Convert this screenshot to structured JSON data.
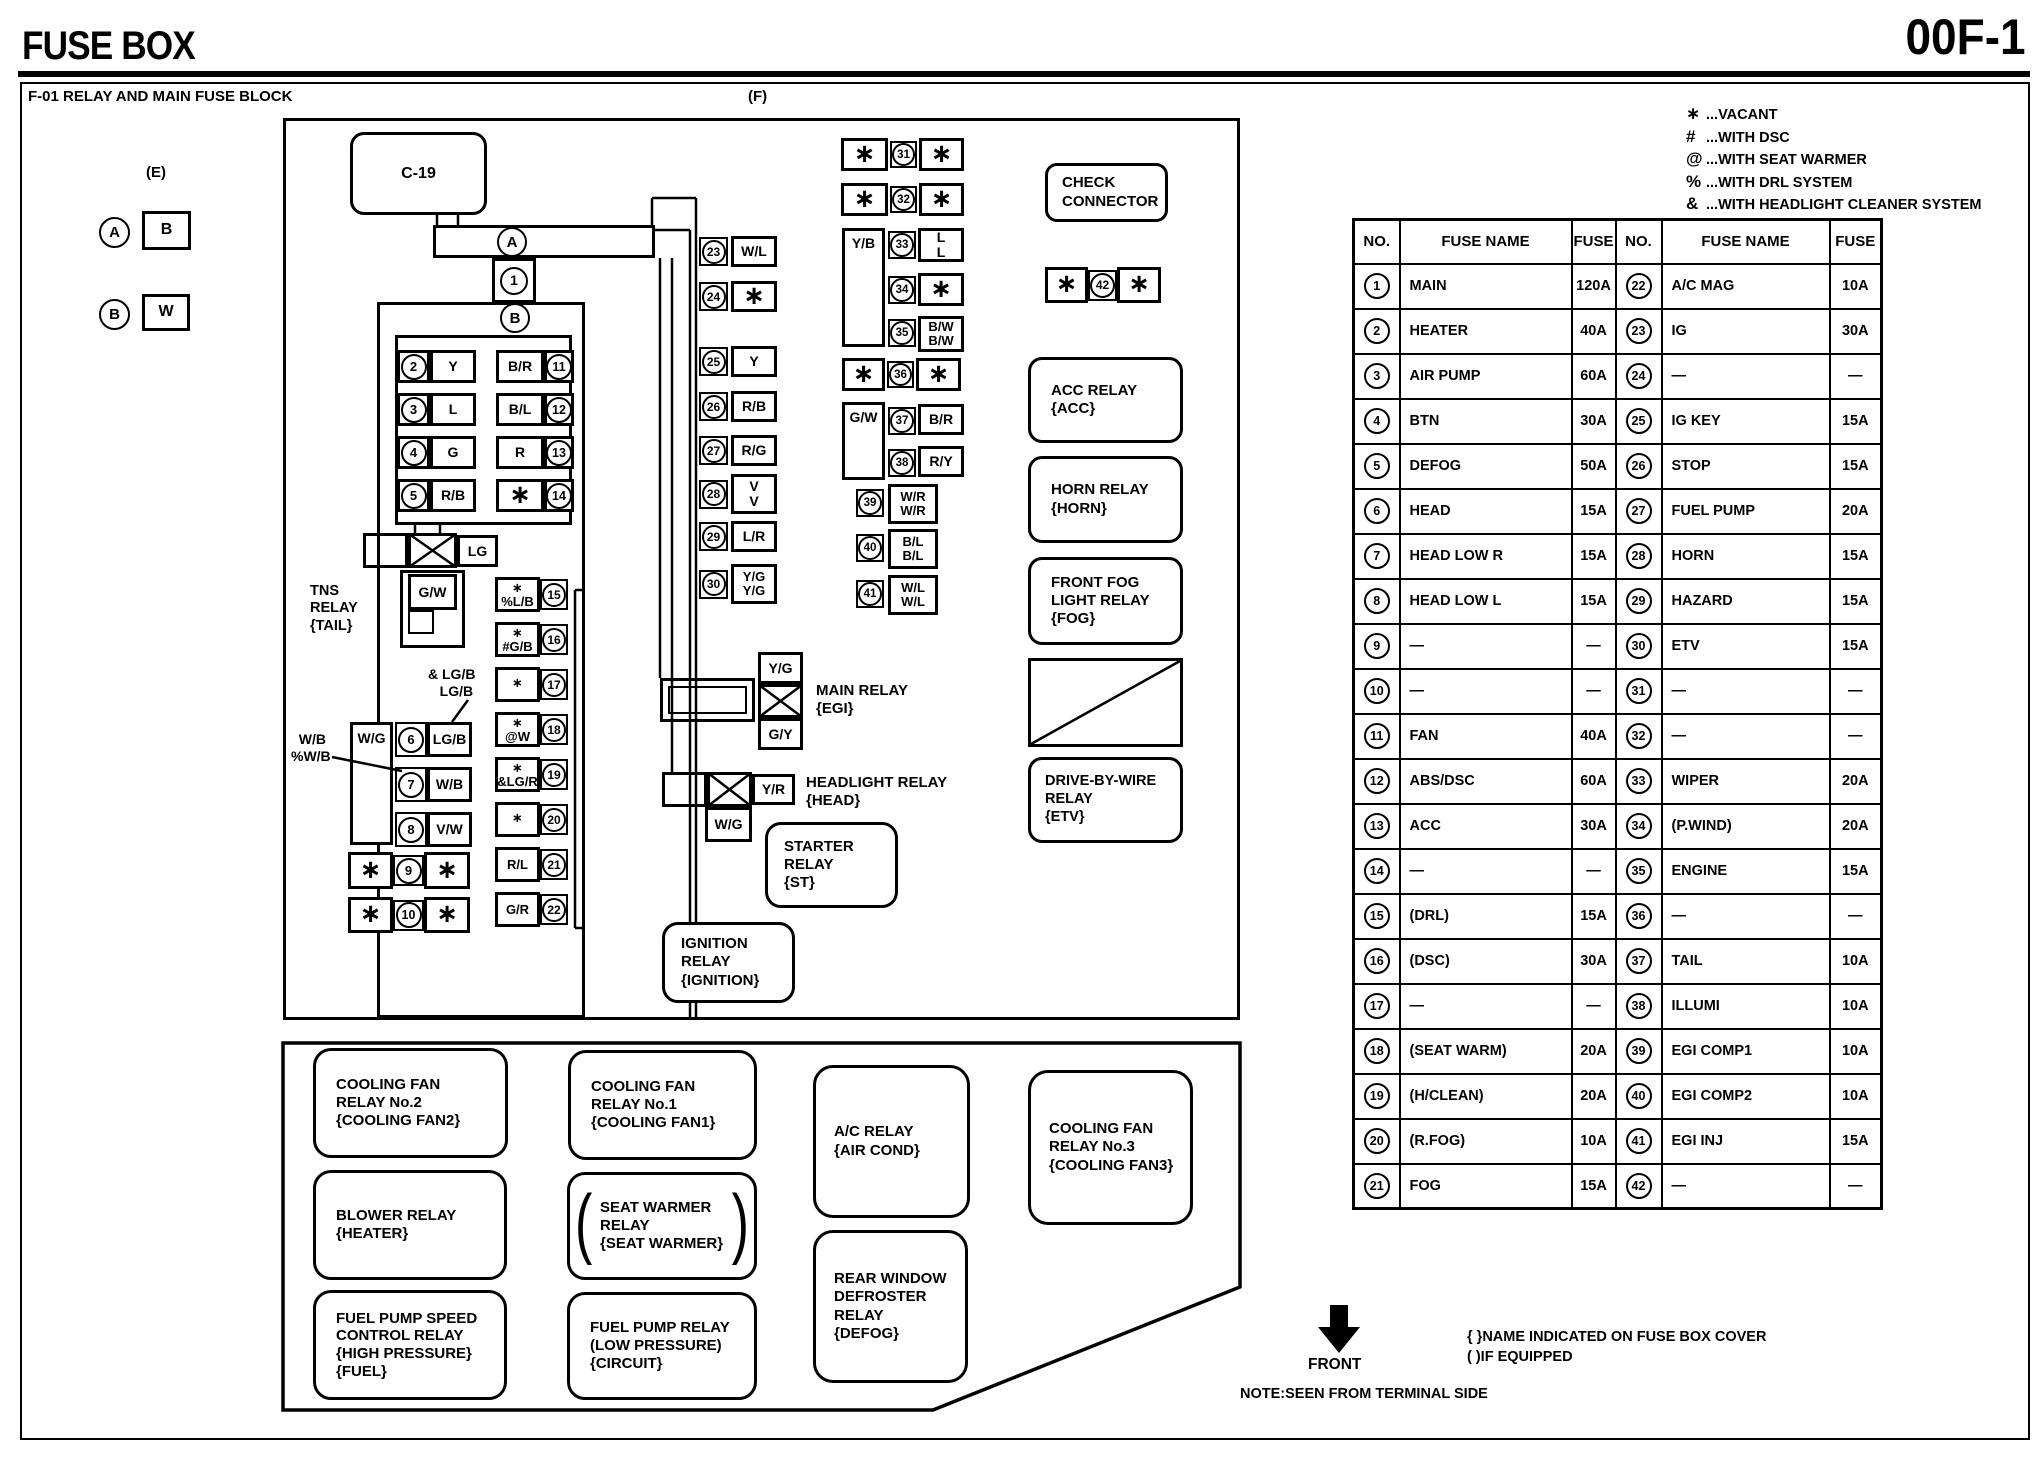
{
  "header": {
    "title": "FUSE BOX",
    "page_code": "00F-1",
    "block_title": "F-01 RELAY AND MAIN FUSE BLOCK",
    "figure_label": "(F)",
    "external_label": "(E)"
  },
  "legend": {
    "items": [
      {
        "symbol": "∗",
        "text": "...VACANT"
      },
      {
        "symbol": "#",
        "text": "...WITH DSC"
      },
      {
        "symbol": "@",
        "text": "...WITH SEAT WARMER"
      },
      {
        "symbol": "%",
        "text": "...WITH DRL SYSTEM"
      },
      {
        "symbol": "&",
        "text": "...WITH HEADLIGHT CLEANER SYSTEM"
      }
    ]
  },
  "connectors": {
    "a_circle": "A",
    "a_box": "B",
    "b_circle": "B",
    "b_box": "W",
    "c19": "C-19",
    "bar_circle": "A",
    "node1": "1",
    "node_b": "B"
  },
  "diagram": {
    "left_block": {
      "rows": [
        {
          "no": "2",
          "label": "Y",
          "rlabel": "B/R",
          "rno": "11"
        },
        {
          "no": "3",
          "label": "L",
          "rlabel": "B/L",
          "rno": "12"
        },
        {
          "no": "4",
          "label": "G",
          "rlabel": "R",
          "rno": "13"
        },
        {
          "no": "5",
          "label": "R/B",
          "rlabel": "∗",
          "rno": "14"
        }
      ]
    },
    "tns": {
      "name": "TNS\nRELAY\n{TAIL}",
      "lg": "LG",
      "gw": "G/W"
    },
    "col_right": {
      "rows": [
        {
          "label": "∗\n%L/B",
          "no": "15"
        },
        {
          "label": "∗\n#G/B",
          "no": "16"
        },
        {
          "label": "∗",
          "no": "17"
        },
        {
          "label": "∗\n@W",
          "no": "18"
        },
        {
          "label": "∗\n&LG/R",
          "no": "19"
        },
        {
          "label": "∗",
          "no": "20"
        },
        {
          "label": "R/L",
          "no": "21"
        },
        {
          "label": "G/R",
          "no": "22"
        }
      ]
    },
    "col_left": {
      "wg": "W/G",
      "rows": [
        {
          "no": "6",
          "label": "LG/B"
        },
        {
          "no": "7",
          "label": "W/B"
        },
        {
          "no": "8",
          "label": "V/W"
        }
      ],
      "star_rows": [
        {
          "l": "∗",
          "no": "9",
          "r": "∗"
        },
        {
          "l": "∗",
          "no": "10",
          "r": "∗"
        }
      ],
      "callout_lgb": "& LG/B\n   LG/B",
      "callout_wb": "  W/B\n%W/B"
    },
    "mid_col": [
      {
        "no": "23",
        "label": "W/L"
      },
      {
        "no": "24",
        "label": "∗"
      },
      {
        "no": "25",
        "label": "Y"
      },
      {
        "no": "26",
        "label": "R/B"
      },
      {
        "no": "27",
        "label": "R/G"
      },
      {
        "no": "28",
        "label": "V\nV"
      },
      {
        "no": "29",
        "label": "L/R"
      },
      {
        "no": "30",
        "label": "Y/G\nY/G"
      }
    ],
    "right_col": {
      "r31": {
        "l": "∗",
        "no": "31",
        "r": "∗"
      },
      "r32": {
        "l": "∗",
        "no": "32",
        "r": "∗"
      },
      "yb": "Y/B",
      "c33": {
        "no": "33",
        "label": "L\nL"
      },
      "c34": {
        "no": "34",
        "label": "∗"
      },
      "c35": {
        "no": "35",
        "label": "B/W\nB/W"
      },
      "r36": {
        "l": "∗",
        "no": "36",
        "r": "∗"
      },
      "gw": "G/W",
      "c37": {
        "no": "37",
        "label": "B/R"
      },
      "c38": {
        "no": "38",
        "label": "R/Y"
      },
      "c39": {
        "no": "39",
        "label": "W/R\nW/R"
      },
      "c40": {
        "no": "40",
        "label": "B/L\nB/L"
      },
      "c41": {
        "no": "41",
        "label": "W/L\nW/L"
      }
    },
    "relays": {
      "main": {
        "yg": "Y/G",
        "gy": "G/Y",
        "name": "MAIN RELAY\n{EGI}"
      },
      "headlight": {
        "yr": "Y/R",
        "wg": "W/G",
        "name": "HEADLIGHT RELAY\n{HEAD}"
      },
      "starter": "STARTER\nRELAY\n{ST}",
      "ignition": "IGNITION\nRELAY\n{IGNITION}",
      "check": "CHECK\nCONNECTOR",
      "row42": {
        "l": "∗",
        "no": "42",
        "r": "∗"
      },
      "acc": "ACC RELAY\n{ACC}",
      "horn": "HORN RELAY\n{HORN}",
      "fog": "FRONT FOG\nLIGHT RELAY\n{FOG}",
      "etv": "DRIVE-BY-WIRE\nRELAY\n{ETV}"
    },
    "bottom_block": {
      "cool2": "COOLING FAN\nRELAY No.2\n{COOLING FAN2}",
      "cool1": "COOLING FAN\nRELAY No.1\n{COOLING FAN1}",
      "blower": "BLOWER RELAY\n{HEATER}",
      "seat": "SEAT WARMER\nRELAY\n{SEAT WARMER}",
      "fuelhigh": "FUEL PUMP SPEED\nCONTROL RELAY\n{HIGH PRESSURE}\n{FUEL}",
      "fuellow": "FUEL PUMP RELAY\n(LOW PRESSURE)\n{CIRCUIT}",
      "ac": "A/C RELAY\n{AIR COND}",
      "defrost": "REAR WINDOW\nDEFROSTER\nRELAY\n{DEFOG}",
      "cool3": "COOLING FAN\nRELAY No.3\n{COOLING FAN3}"
    }
  },
  "fuse_table": {
    "headers": [
      "NO.",
      "FUSE NAME",
      "FUSE",
      "NO.",
      "FUSE NAME",
      "FUSE"
    ],
    "rows": [
      [
        "1",
        "MAIN",
        "120A",
        "22",
        "A/C MAG",
        "10A"
      ],
      [
        "2",
        "HEATER",
        "40A",
        "23",
        "IG",
        "30A"
      ],
      [
        "3",
        "AIR PUMP",
        "60A",
        "24",
        "—",
        "—"
      ],
      [
        "4",
        "BTN",
        "30A",
        "25",
        "IG KEY",
        "15A"
      ],
      [
        "5",
        "DEFOG",
        "50A",
        "26",
        "STOP",
        "15A"
      ],
      [
        "6",
        "HEAD",
        "15A",
        "27",
        "FUEL PUMP",
        "20A"
      ],
      [
        "7",
        "HEAD LOW R",
        "15A",
        "28",
        "HORN",
        "15A"
      ],
      [
        "8",
        "HEAD LOW L",
        "15A",
        "29",
        "HAZARD",
        "15A"
      ],
      [
        "9",
        "—",
        "—",
        "30",
        "ETV",
        "15A"
      ],
      [
        "10",
        "—",
        "—",
        "31",
        "—",
        "—"
      ],
      [
        "11",
        "FAN",
        "40A",
        "32",
        "—",
        "—"
      ],
      [
        "12",
        "ABS/DSC",
        "60A",
        "33",
        "WIPER",
        "20A"
      ],
      [
        "13",
        "ACC",
        "30A",
        "34",
        "(P.WIND)",
        "20A"
      ],
      [
        "14",
        "—",
        "—",
        "35",
        "ENGINE",
        "15A"
      ],
      [
        "15",
        "(DRL)",
        "15A",
        "36",
        "—",
        "—"
      ],
      [
        "16",
        "(DSC)",
        "30A",
        "37",
        "TAIL",
        "10A"
      ],
      [
        "17",
        "—",
        "—",
        "38",
        "ILLUMI",
        "10A"
      ],
      [
        "18",
        "(SEAT WARM)",
        "20A",
        "39",
        "EGI COMP1",
        "10A"
      ],
      [
        "19",
        "(H/CLEAN)",
        "20A",
        "40",
        "EGI COMP2",
        "10A"
      ],
      [
        "20",
        "(R.FOG)",
        "10A",
        "41",
        "EGI INJ",
        "15A"
      ],
      [
        "21",
        "FOG",
        "15A",
        "42",
        "—",
        "—"
      ]
    ]
  },
  "footer": {
    "front_label": "FRONT",
    "note_cover": "{ }NAME INDICATED ON FUSE BOX COVER",
    "note_equipped": "( )IF EQUIPPED",
    "note_terminal": "NOTE:SEEN FROM TERMINAL SIDE"
  }
}
